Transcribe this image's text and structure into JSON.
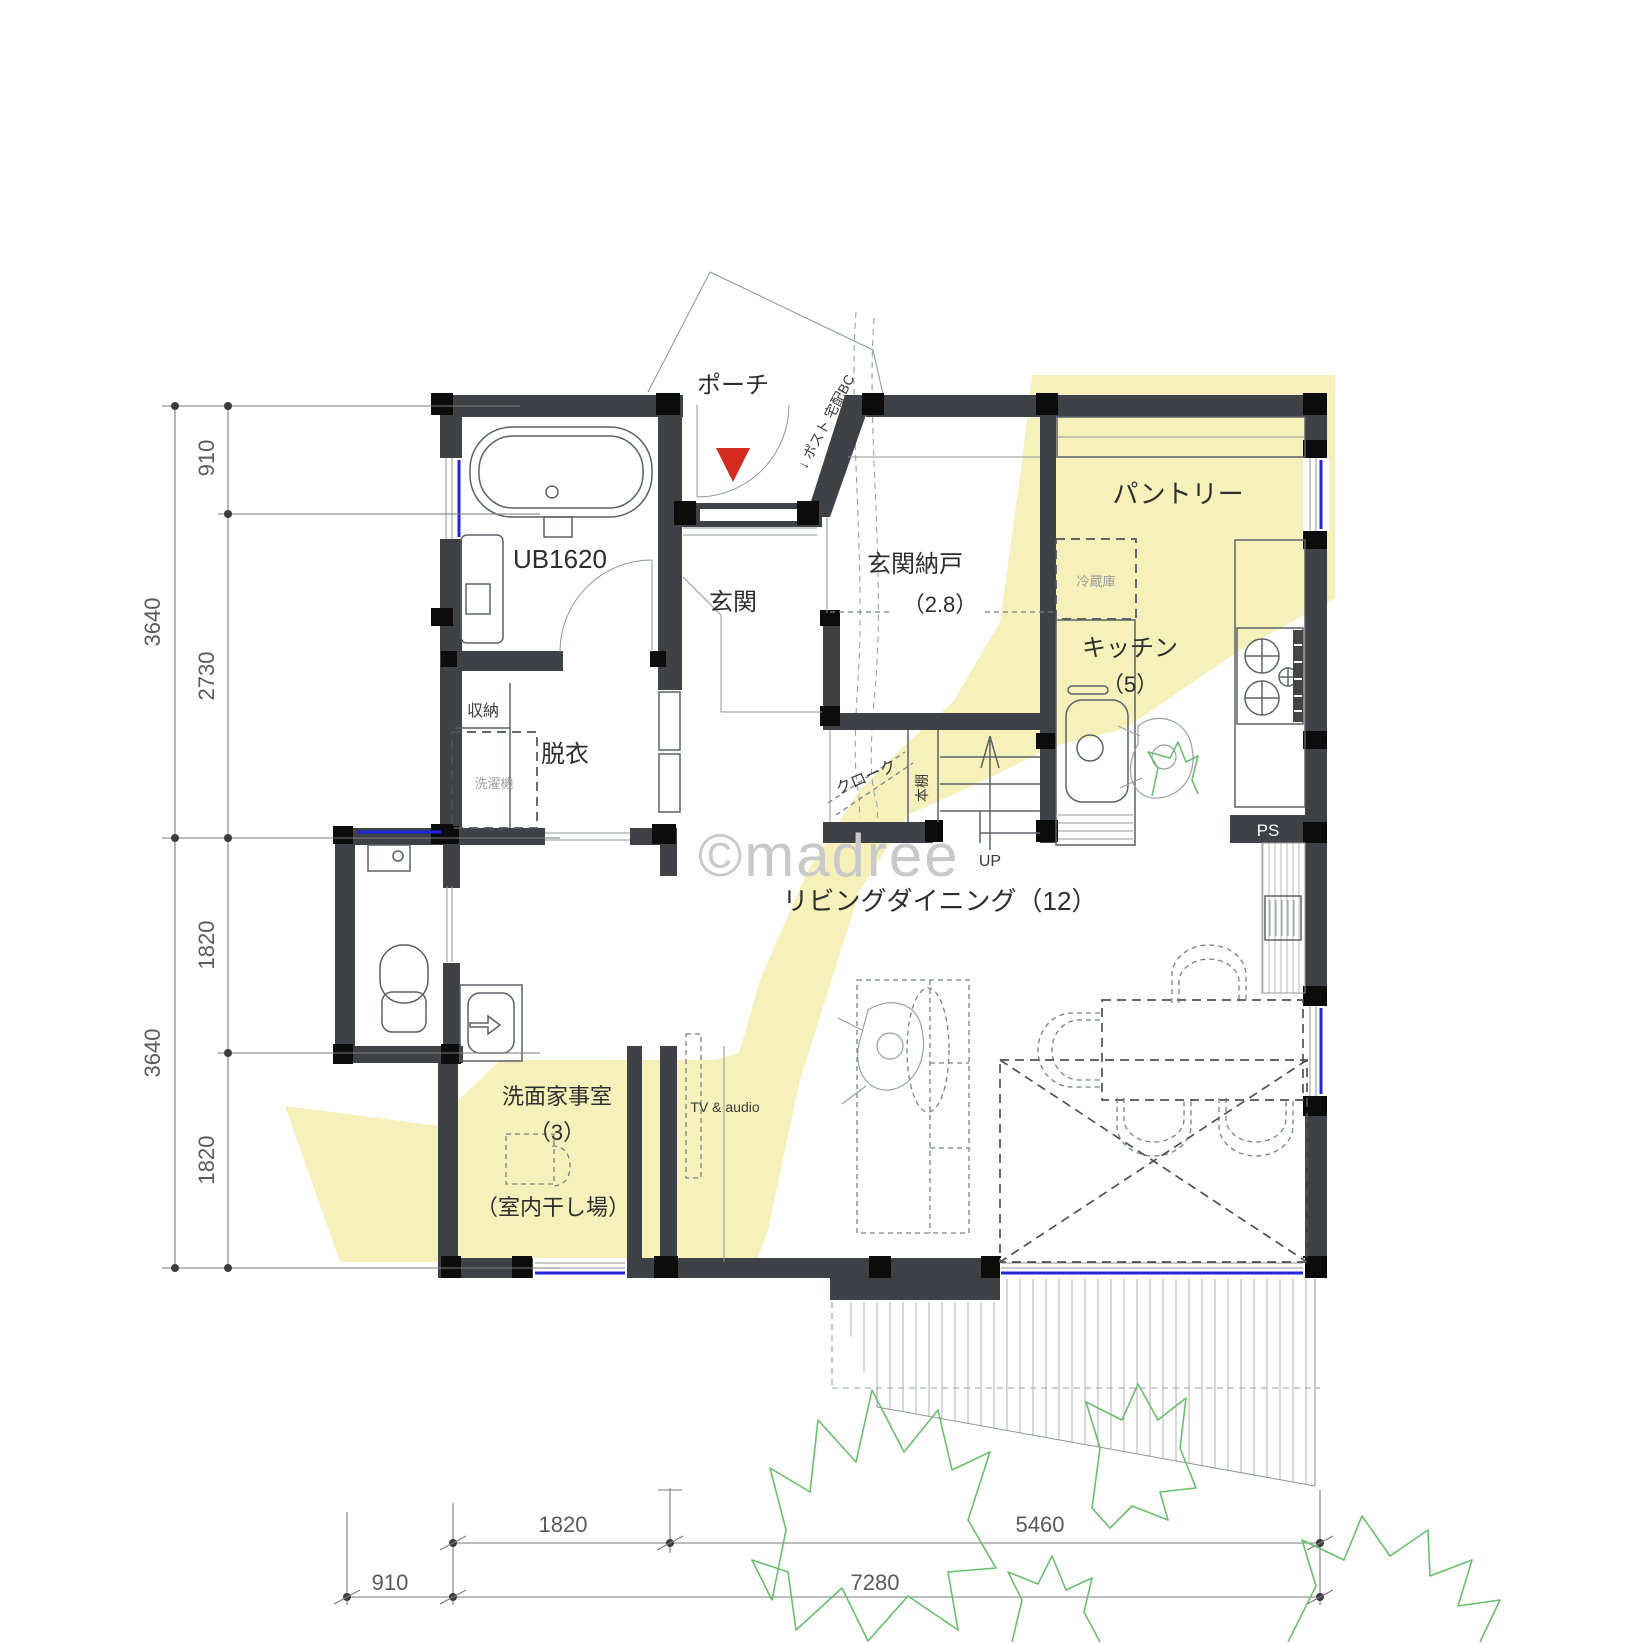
{
  "plan": {
    "watermark": "©madree",
    "rooms": {
      "porch": "ポーチ",
      "entrance": "玄関",
      "entrance_storage": "玄関納戸",
      "entrance_storage_area": "（2.8）",
      "pantry": "パントリー",
      "refrigerator": "冷蔵庫",
      "kitchen": "キッチン",
      "kitchen_area": "（5）",
      "unit_bath": "UB1620",
      "storage": "収納",
      "dressing_room": "脱衣",
      "washing_machine": "洗濯機",
      "cloak": "クローク",
      "bookshelf": "本棚",
      "stairs": "UP",
      "pipe_space": "PS",
      "living_dining": "リビングダイニング（12）",
      "laundry_room": "洗面家事室",
      "laundry_room_area": "（3）",
      "indoor_drying": "（室内干し場）",
      "tv_audio": "TV & audio",
      "post_delivery": "↓ ポスト 宅配BC"
    },
    "dimensions": {
      "left_outer": [
        "3640",
        "3640"
      ],
      "left_inner": [
        "910",
        "2730",
        "1820",
        "1820"
      ],
      "bottom_upper": [
        "1820",
        "5460"
      ],
      "bottom_lower": [
        "910",
        "7280"
      ]
    },
    "colors": {
      "wall": "#3e4247",
      "column": "#0c0c0c",
      "highlight": "#f6f1ba",
      "window_blue": "#2424dd",
      "entry_marker_red": "#d42a20",
      "tree_green": "#6abf6e",
      "watermark_gray": "#c9c9c9"
    }
  }
}
